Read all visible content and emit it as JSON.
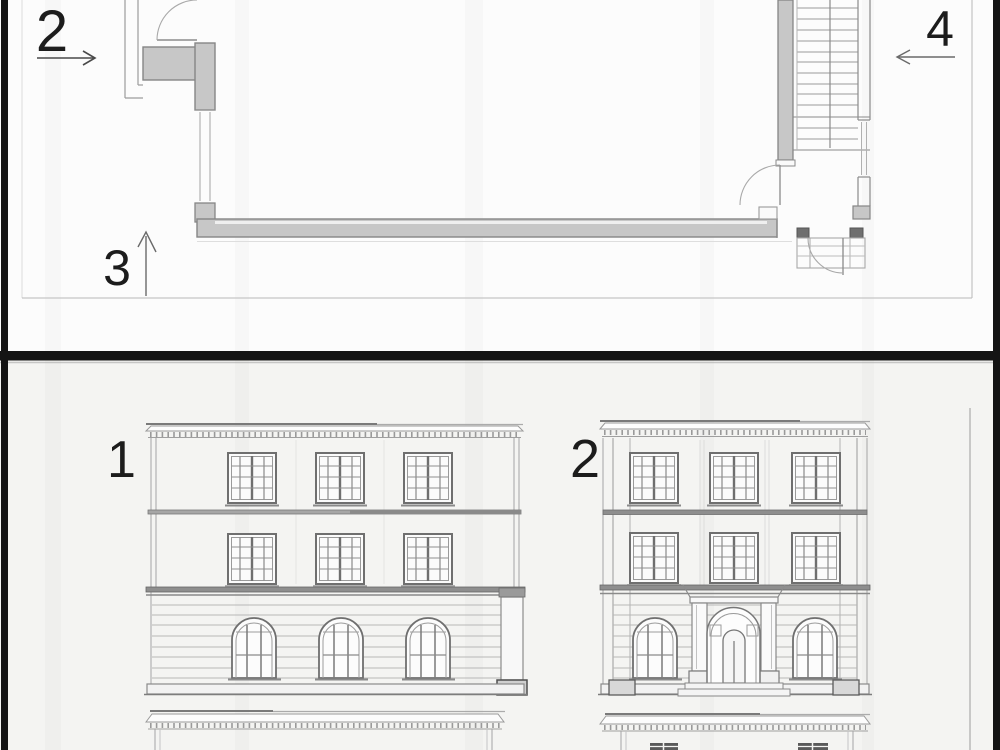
{
  "plan_panel": {
    "description": "floor plan with section/view markers",
    "view_markers": [
      {
        "label": "2",
        "direction": "right"
      },
      {
        "label": "3",
        "direction": "up"
      },
      {
        "label": "4",
        "direction": "left"
      }
    ]
  },
  "elevation_panel": {
    "description": "building facade elevations",
    "elevations": [
      {
        "label": "1"
      },
      {
        "label": "2"
      }
    ]
  },
  "colors": {
    "panel_top_bg": "#fcfcfc",
    "panel_bottom_bg": "#f4f4f2",
    "frame_black": "#141414",
    "wall_fill": "#c7c7c7",
    "line_dark": "#6f6f6f",
    "line_light": "#9c9c9c",
    "label_text": "#1c1c1c"
  }
}
